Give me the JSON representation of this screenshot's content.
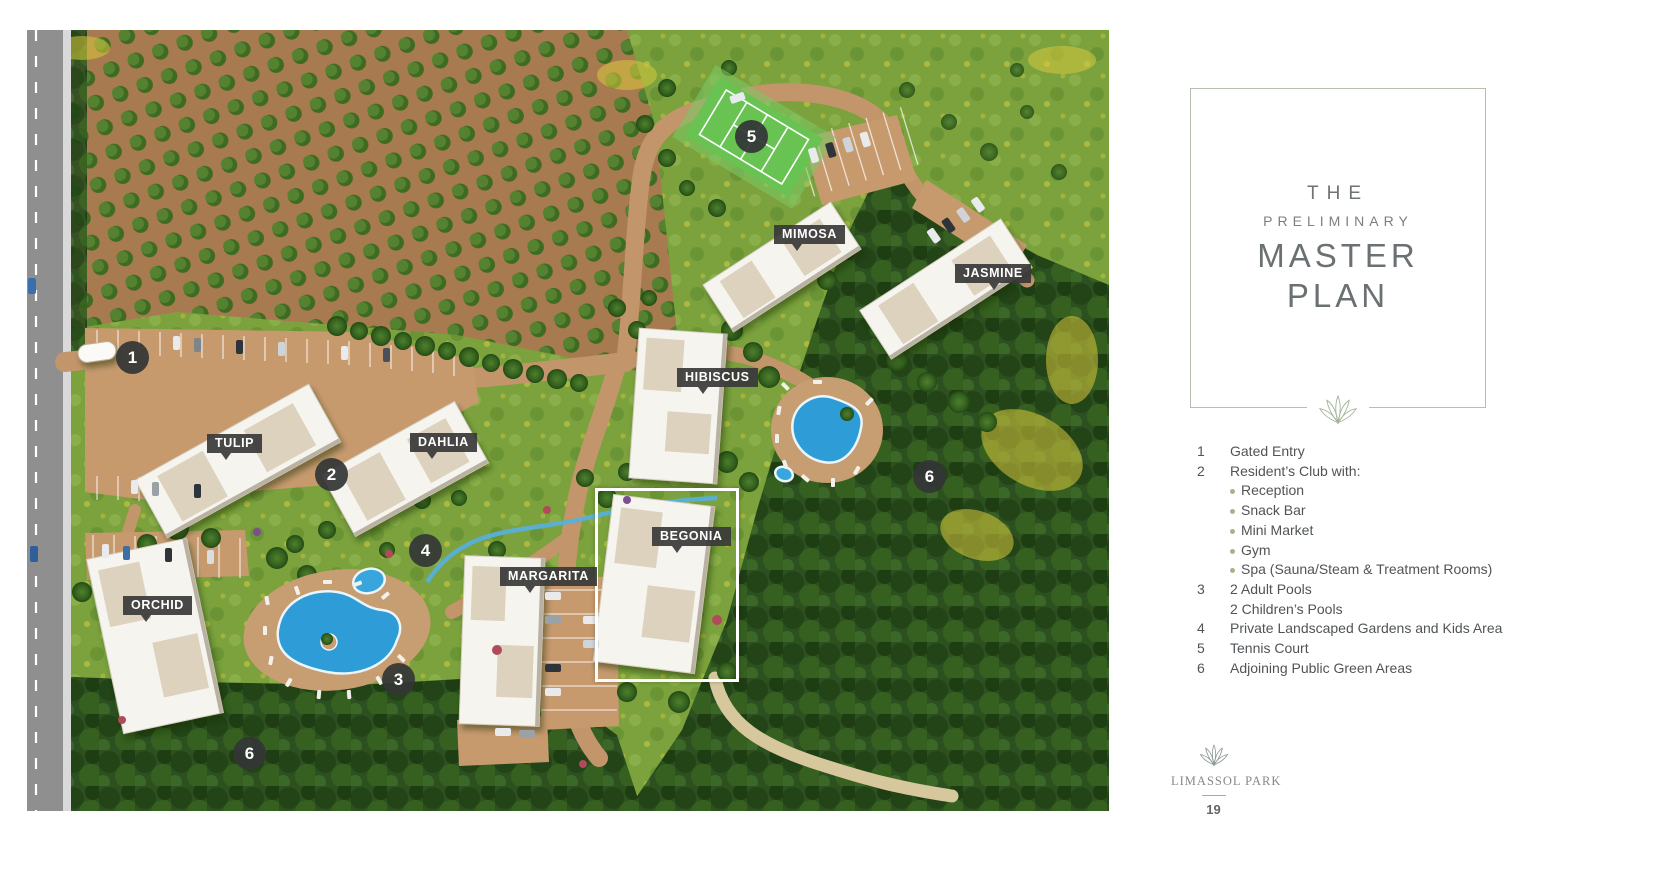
{
  "map": {
    "labels": [
      {
        "text": "MIMOSA"
      },
      {
        "text": "JASMINE"
      },
      {
        "text": "HIBISCUS"
      },
      {
        "text": "TULIP"
      },
      {
        "text": "DAHLIA"
      },
      {
        "text": "BEGONIA"
      },
      {
        "text": "MARGARITA"
      },
      {
        "text": "ORCHID"
      }
    ],
    "markers": [
      {
        "number": "1"
      },
      {
        "number": "2"
      },
      {
        "number": "3"
      },
      {
        "number": "4"
      },
      {
        "number": "5"
      },
      {
        "number": "6"
      },
      {
        "number": "6"
      }
    ],
    "highlighted_building": "BEGONIA"
  },
  "panel": {
    "title": {
      "line1": "THE",
      "line2": "PRELIMINARY",
      "line3": "MASTER",
      "line4": "PLAN"
    },
    "legend": [
      {
        "n": "1",
        "t": "Gated Entry"
      },
      {
        "n": "2",
        "t": "Resident’s Club with:"
      },
      {
        "t": "Reception"
      },
      {
        "t": "Snack Bar"
      },
      {
        "t": "Mini Market"
      },
      {
        "t": "Gym"
      },
      {
        "t": "Spa (Sauna/Steam & Treatment Rooms)"
      },
      {
        "n": "3",
        "t": "2 Adult Pools"
      },
      {
        "n": "",
        "t": "2 Children’s Pools"
      },
      {
        "n": "4",
        "t": "Private Landscaped Gardens and Kids Area"
      },
      {
        "n": "5",
        "t": "Tennis Court"
      },
      {
        "n": "6",
        "t": "Adjoining Public Green Areas"
      }
    ],
    "brand": "LIMASSOL PARK",
    "page_number": "19"
  },
  "colors": {
    "accent_sage": "#a8b7a0",
    "card_border": "#b5c1ae",
    "title_gray": "#6b7173",
    "legend_text": "#505456",
    "bullet_dot": "#a6b288",
    "label_bg": "#383838",
    "marker_bg": "#343636",
    "pool_blue": "#2e9cd6",
    "road_tan": "#c3956a",
    "tennis_green": "#68c353"
  }
}
